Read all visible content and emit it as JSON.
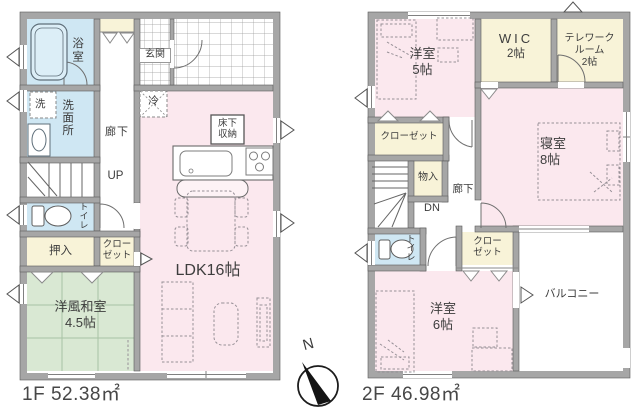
{
  "floor1": {
    "area_label": "1F 52.38㎡",
    "labels": {
      "bathroom": "浴室",
      "washer": "洗",
      "washroom": "洗面所",
      "hallway": "廊下",
      "entrance": "玄関",
      "stairs_up": "UP",
      "refrigerator": "冷",
      "underfloor_storage_1": "床下",
      "underfloor_storage_2": "収納",
      "toilet": "トイレ",
      "oshiire": "押入",
      "closet_1": "クロー",
      "closet_2": "ゼット",
      "japanese_room_1": "洋風和室",
      "japanese_room_2": "4.5帖",
      "ldk": "LDK16帖"
    }
  },
  "floor2": {
    "area_label": "2F 46.98㎡",
    "labels": {
      "bedroom5_1": "洋室",
      "bedroom5_2": "5帖",
      "wic_1": "WIC",
      "wic_2": "2帖",
      "telework_1": "テレワーク",
      "telework_2": "ルーム",
      "telework_3": "2帖",
      "closet_upper": "クローゼット",
      "storage": "物入",
      "hallway": "廊下",
      "stairs_down": "DN",
      "master_1": "寝室",
      "master_2": "8帖",
      "toilet": "トイレ",
      "closet_lower_1": "クロー",
      "closet_lower_2": "ゼット",
      "bedroom6_1": "洋室",
      "bedroom6_2": "6帖",
      "balcony": "バルコニー"
    }
  },
  "compass": {
    "north_label": "N"
  },
  "colors": {
    "wall": "#a6a6a6",
    "outline": "#5a5a5a",
    "room_pink": "#fbe8ee",
    "room_blue": "#cfe7f3",
    "room_cream": "#f8f3d8",
    "room_green": "#d9e8d3",
    "text": "#3d3d3d"
  }
}
